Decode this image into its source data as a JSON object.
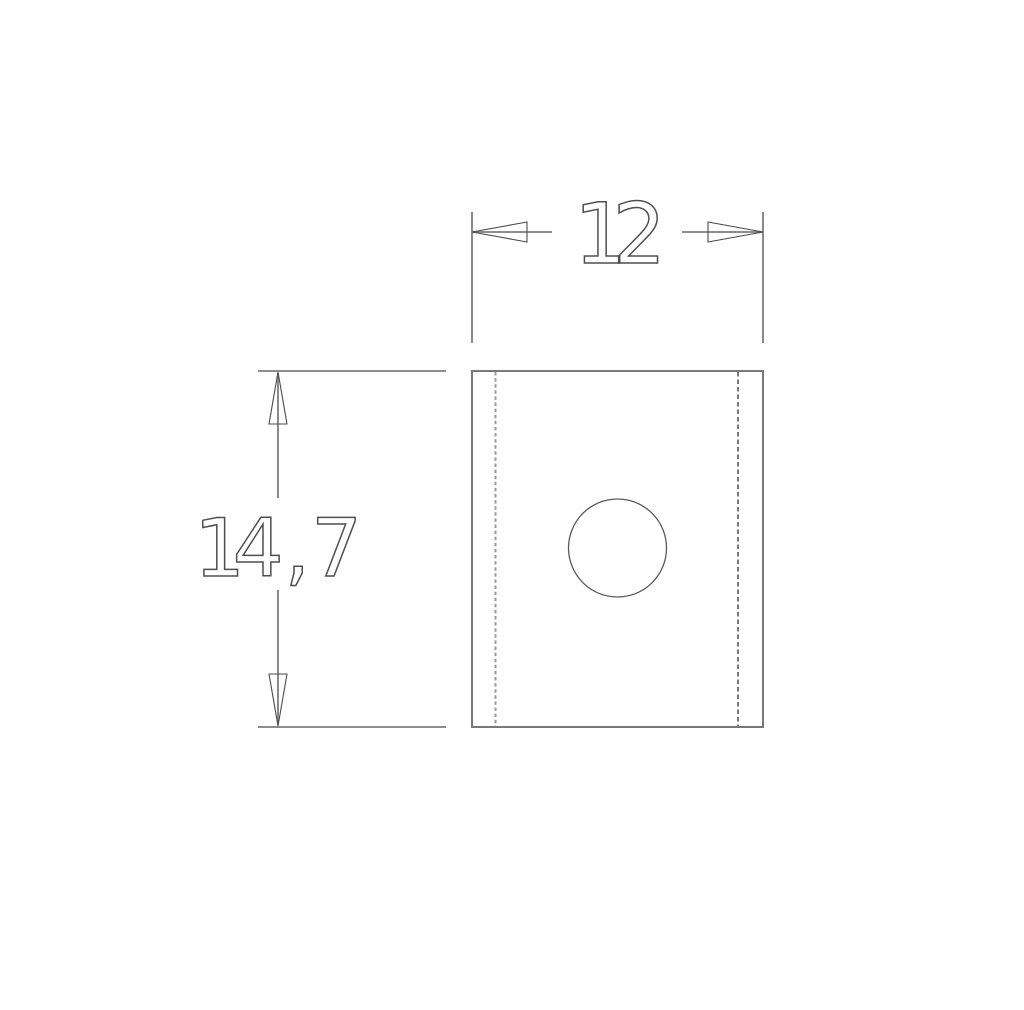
{
  "colors": {
    "outline": "#787878",
    "dimension_line": "#7d7d7d",
    "arrowhead": "#4c4c4c",
    "hole": "#5a5a5a",
    "bend_line_left": "#9a9a9a",
    "bend_line_right": "#3f3f3f",
    "label_text": "#4f4f4f"
  },
  "dimensions": {
    "width": {
      "label": "12",
      "value": 12
    },
    "height": {
      "label": "14 , 7",
      "value": 14.7
    }
  }
}
